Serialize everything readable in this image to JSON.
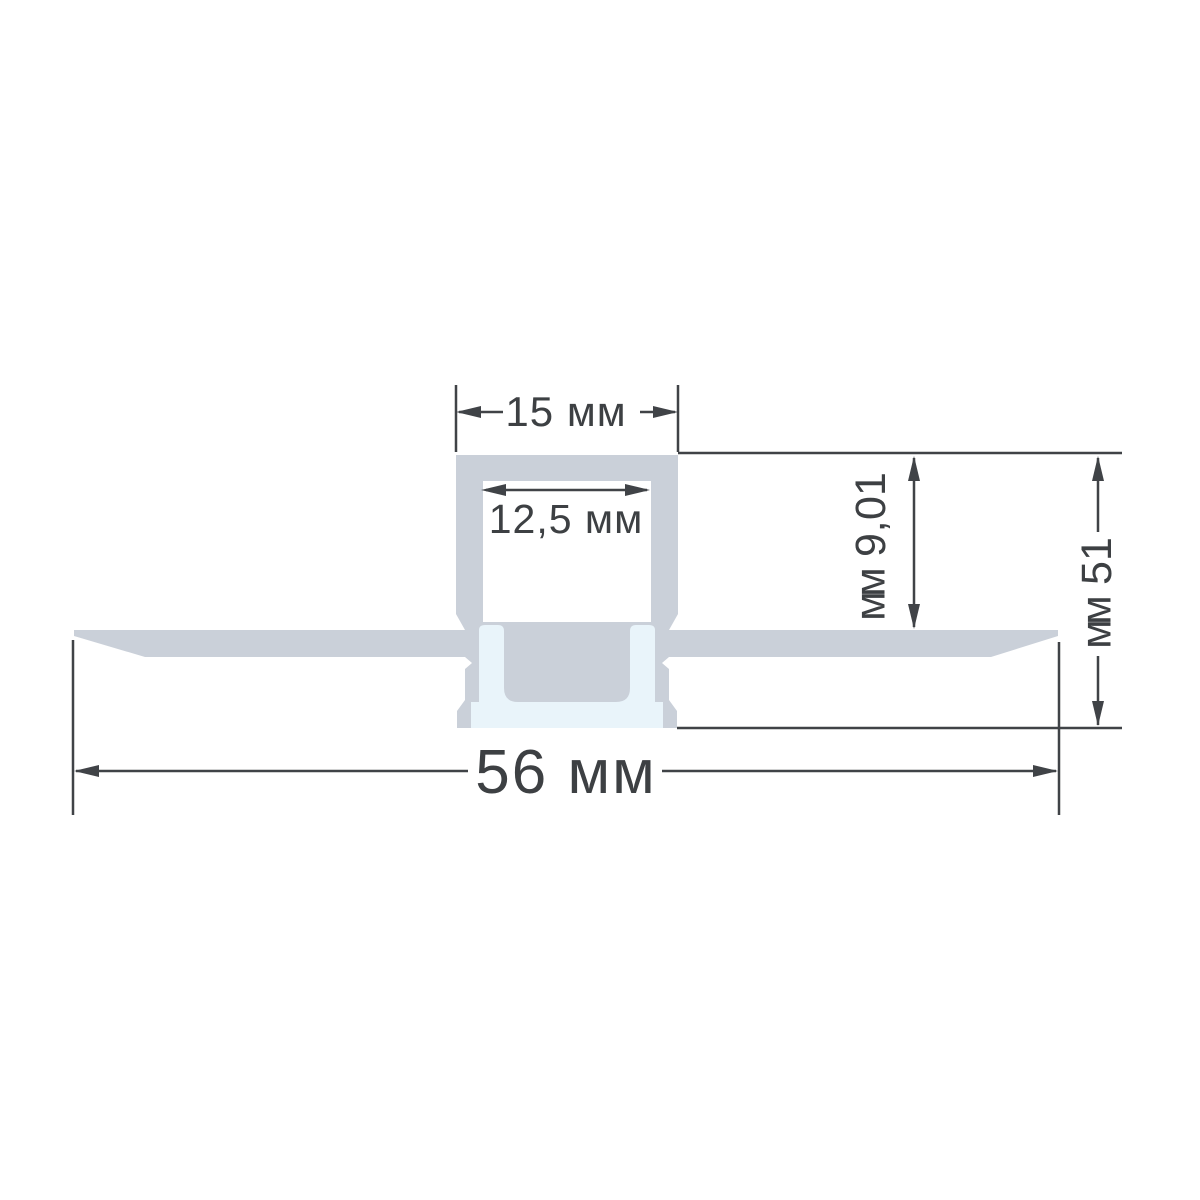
{
  "drawing": {
    "subject": "recessed-led-aluminum-profile-cross-section",
    "units": "мм",
    "dimensions": {
      "top_outer_width": "15 мм",
      "inner_width": "12,5 мм",
      "inner_depth": "10,9 мм",
      "total_height": "15 мм",
      "overall_width": "56 мм"
    },
    "colors": {
      "aluminum_body": "#cad0d9",
      "diffuser_insert": "#e9f4fa",
      "dimension_lines": "#404347",
      "label_text": "#3d4043",
      "background": "#ffffff"
    }
  }
}
